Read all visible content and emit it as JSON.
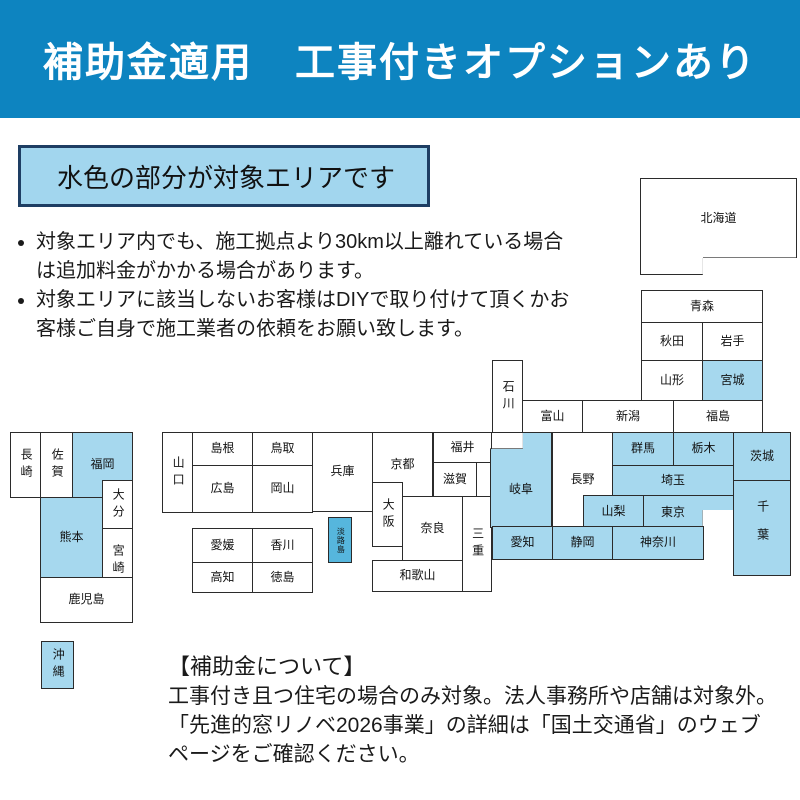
{
  "banner": {
    "title": "補助金適用　工事付きオプションあり"
  },
  "legend": {
    "label": "水色の部分が対象エリアです"
  },
  "bullets": [
    "対象エリア内でも、施工拠点より30km以上離れている場合は追加料金がかかる場合があります。",
    "対象エリアに該当しないお客様はDIYで取り付けて頂くかお客様ご自身で施工業者の依頼をお願い致します。"
  ],
  "subsidy_note": {
    "title": "【補助金について】",
    "lines": [
      "工事付き且つ住宅の場合のみ対象。法人事務所や店舗は対象外。",
      "「先進的窓リノベ2026事業」の詳細は「国土交通省」のウェブ",
      "ページをご確認ください。"
    ]
  },
  "colors": {
    "banner_bg": "#0d84c0",
    "banner_text": "#ffffff",
    "target_area_fill": "#a6d8ee",
    "awaji_fill": "#56b6dd",
    "non_target_fill": "#ffffff",
    "map_border": "#2b2b2b",
    "legend_fill": "#a2d6ee",
    "legend_border": "#1e3e63"
  },
  "map": {
    "prefectures": [
      {
        "name": "北海道",
        "target": false
      },
      {
        "name": "青森",
        "target": false
      },
      {
        "name": "秋田",
        "target": false
      },
      {
        "name": "岩手",
        "target": false
      },
      {
        "name": "山形",
        "target": false
      },
      {
        "name": "宮城",
        "target": true
      },
      {
        "name": "新潟",
        "target": false
      },
      {
        "name": "福島",
        "target": false
      },
      {
        "name": "富山",
        "target": false
      },
      {
        "name": "石川",
        "target": false
      },
      {
        "name": "福井",
        "target": false
      },
      {
        "name": "滋賀",
        "target": false
      },
      {
        "name": "京都",
        "target": false
      },
      {
        "name": "大阪",
        "target": false
      },
      {
        "name": "奈良",
        "target": false
      },
      {
        "name": "和歌山",
        "target": false
      },
      {
        "name": "三重",
        "target": false
      },
      {
        "name": "岐阜",
        "target": true
      },
      {
        "name": "長野",
        "target": false
      },
      {
        "name": "山梨",
        "target": true
      },
      {
        "name": "群馬",
        "target": true
      },
      {
        "name": "栃木",
        "target": true
      },
      {
        "name": "茨城",
        "target": true
      },
      {
        "name": "埼玉",
        "target": true
      },
      {
        "name": "東京",
        "target": true
      },
      {
        "name": "千葉",
        "target": true
      },
      {
        "name": "神奈川",
        "target": true
      },
      {
        "name": "静岡",
        "target": true
      },
      {
        "name": "愛知",
        "target": true
      },
      {
        "name": "兵庫",
        "target": false
      },
      {
        "name": "淡路島",
        "target": true
      },
      {
        "name": "鳥取",
        "target": false
      },
      {
        "name": "島根",
        "target": false
      },
      {
        "name": "岡山",
        "target": false
      },
      {
        "name": "広島",
        "target": false
      },
      {
        "name": "山口",
        "target": false
      },
      {
        "name": "香川",
        "target": false
      },
      {
        "name": "愛媛",
        "target": false
      },
      {
        "name": "徳島",
        "target": false
      },
      {
        "name": "高知",
        "target": false
      },
      {
        "name": "福岡",
        "target": true
      },
      {
        "name": "大分",
        "target": false
      },
      {
        "name": "佐賀",
        "target": false
      },
      {
        "name": "長崎",
        "target": false
      },
      {
        "name": "熊本",
        "target": true
      },
      {
        "name": "宮崎",
        "target": false
      },
      {
        "name": "鹿児島",
        "target": false
      },
      {
        "name": "沖縄",
        "target": true
      }
    ]
  }
}
